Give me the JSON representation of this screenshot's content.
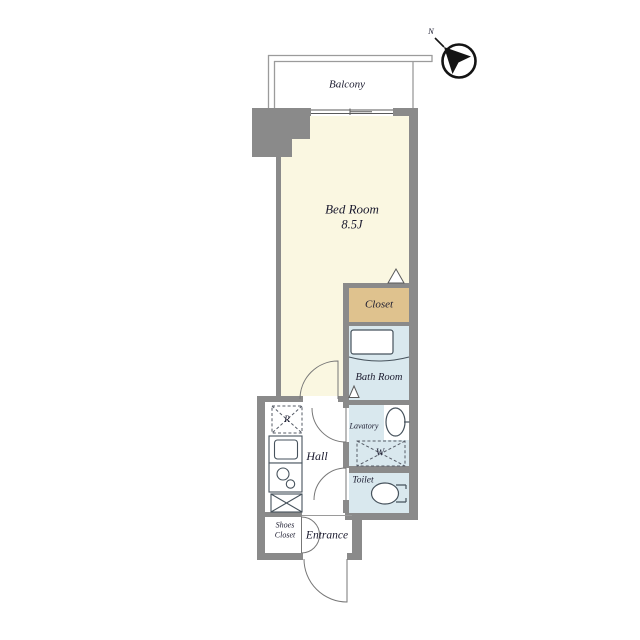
{
  "compass": {
    "north_label": "N"
  },
  "rooms": {
    "balcony": {
      "label": "Balcony"
    },
    "bedroom": {
      "label": "Bed Room",
      "size": "8.5J"
    },
    "closet": {
      "label": "Closet"
    },
    "bathroom": {
      "label": "Bath Room"
    },
    "lavatory": {
      "label": "Lavatory"
    },
    "toilet": {
      "label": "Toilet"
    },
    "hall": {
      "label": "Hall"
    },
    "entrance": {
      "label": "Entrance"
    },
    "shoes_closet": {
      "line1": "Shoes",
      "line2": "Closet"
    }
  },
  "symbols": {
    "washer": "W",
    "refrigerator": "R"
  },
  "colors": {
    "wall": "#8a8a8a",
    "bedroom_floor": "#faf7e1",
    "closet_floor": "#dfc28e",
    "wet_area_floor": "#d9e8ee",
    "fixture_line": "#46525c",
    "text": "#1b1b2f"
  }
}
